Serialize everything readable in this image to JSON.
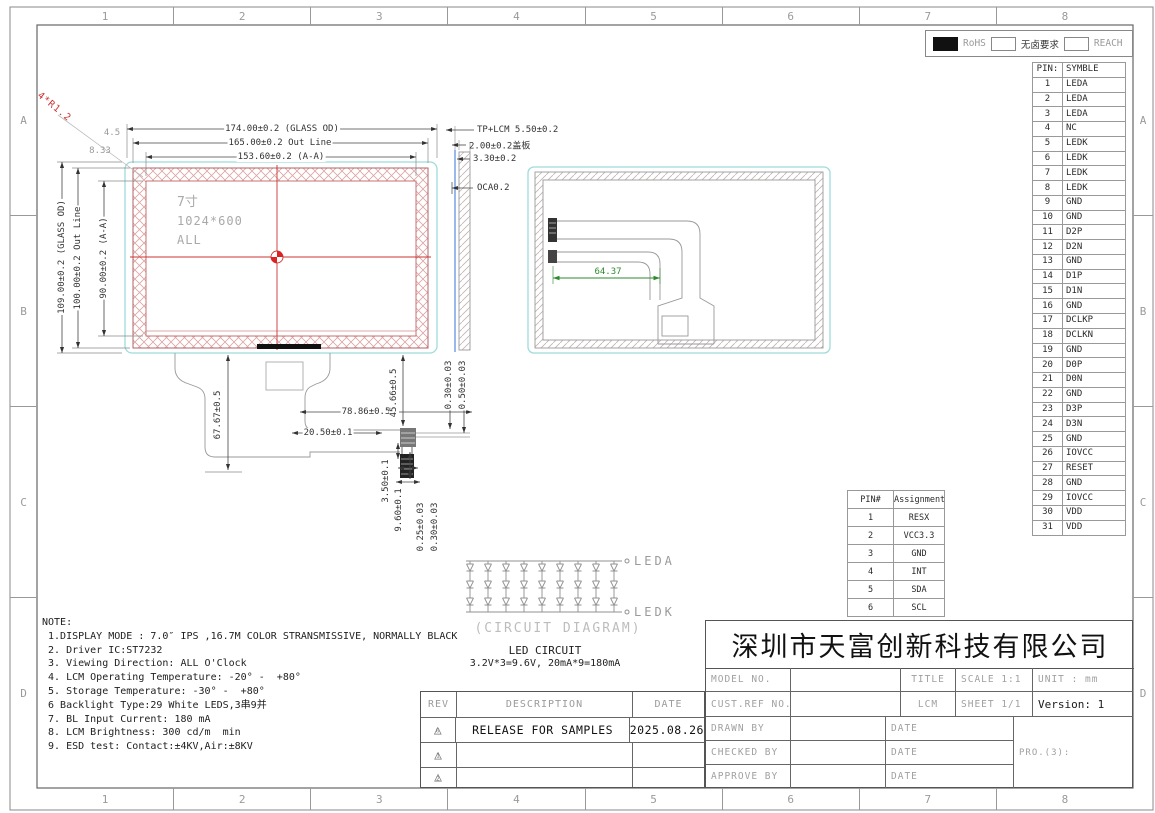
{
  "frame": {
    "cols": [
      "1",
      "2",
      "3",
      "4",
      "5",
      "6",
      "7",
      "8"
    ],
    "rows": [
      "A",
      "B",
      "C",
      "D"
    ]
  },
  "compliance": {
    "rohs": "RoHS",
    "halogen": "无卤要求",
    "reach": "REACH"
  },
  "pin_table": {
    "col1": "PIN:",
    "col2": "SYMBLE",
    "rows": [
      [
        "1",
        "LEDA"
      ],
      [
        "2",
        "LEDA"
      ],
      [
        "3",
        "LEDA"
      ],
      [
        "4",
        "NC"
      ],
      [
        "5",
        "LEDK"
      ],
      [
        "6",
        "LEDK"
      ],
      [
        "7",
        "LEDK"
      ],
      [
        "8",
        "LEDK"
      ],
      [
        "9",
        "GND"
      ],
      [
        "10",
        "GND"
      ],
      [
        "11",
        "D2P"
      ],
      [
        "12",
        "D2N"
      ],
      [
        "13",
        "GND"
      ],
      [
        "14",
        "D1P"
      ],
      [
        "15",
        "D1N"
      ],
      [
        "16",
        "GND"
      ],
      [
        "17",
        "DCLKP"
      ],
      [
        "18",
        "DCLKN"
      ],
      [
        "19",
        "GND"
      ],
      [
        "20",
        "D0P"
      ],
      [
        "21",
        "D0N"
      ],
      [
        "22",
        "GND"
      ],
      [
        "23",
        "D3P"
      ],
      [
        "24",
        "D3N"
      ],
      [
        "25",
        "GND"
      ],
      [
        "26",
        "IOVCC"
      ],
      [
        "27",
        "RESET"
      ],
      [
        "28",
        "GND"
      ],
      [
        "29",
        "IOVCC"
      ],
      [
        "30",
        "VDD"
      ],
      [
        "31",
        "VDD"
      ]
    ]
  },
  "tp_table": {
    "col1": "PIN#",
    "col2": "Assignment",
    "rows": [
      [
        "1",
        "RESX"
      ],
      [
        "2",
        "VCC3.3"
      ],
      [
        "3",
        "GND"
      ],
      [
        "4",
        "INT"
      ],
      [
        "5",
        "SDA"
      ],
      [
        "6",
        "SCL"
      ]
    ]
  },
  "front_view": {
    "size": "7寸",
    "resolution": "1024*600",
    "mode": "ALL"
  },
  "dims": {
    "glass_w": "174.00±0.2 (GLASS OD)",
    "outline_w": "165.00±0.2 Out Line",
    "aa_w": "153.60±0.2 (A-A)",
    "glass_h": "109.00±0.2 (GLASS OD)",
    "outline_h": "100.00±0.2 Out Line",
    "aa_h": "90.00±0.2 (A-A)",
    "corner_r": "4*R1.2",
    "corner_a": "4.5",
    "corner_b": "8.33",
    "fpc_drop": "67.67±0.5",
    "fpc_w": "78.86±0.5",
    "fpc_off": "20.50±0.1",
    "cable_len": "45.66±0.5",
    "t1": "0.30±0.03",
    "t2": "0.50±0.03",
    "gap": "3.50±0.1",
    "conn_len": "9.60±0.1",
    "t3": "0.25±0.03",
    "t4": "0.30±0.03",
    "back_cable": "64.37"
  },
  "side_view": {
    "l1": "TP+LCM 5.50±0.2",
    "l2": "2.00±0.2盖板",
    "l3": "3.30±0.2",
    "l4": "OCA0.2"
  },
  "circuit": {
    "anode": "LEDA",
    "cathode": "LEDK",
    "caption": "(CIRCUIT DIAGRAM)",
    "title": "LED CIRCUIT",
    "spec": "3.2V*3=9.6V, 20mA*9=180mA"
  },
  "notes": {
    "title": "NOTE:",
    "lines": [
      " 1.DISPLAY MODE : 7.0″ IPS ,16.7M COLOR STRANSMISSIVE, NORMALLY BLACK",
      " 2. Driver IC:ST7232",
      " 3. Viewing Direction: ALL O'Clock",
      " 4. LCM Operating Temperature: -20° -  +80°",
      " 5. Storage Temperature: -30° -  +80°",
      " 6 Backlight Type:29 White LEDS,3串9并",
      " 7. BL Input Current: 180 mA",
      " 8. LCM Brightness: 300 cd/m  min",
      " 9. ESD test: Contact:±4KV,Air:±8KV"
    ]
  },
  "title_block": {
    "company": "深圳市天富创新科技有限公司",
    "model_no": "MODEL NO.",
    "cust_ref": "CUST.REF NO.",
    "title_lbl": "TITLE",
    "scale": "SCALE 1:1",
    "unit": "UNIT : mm",
    "lcm": "LCM",
    "sheet": "SHEET 1/1",
    "version": "Version: 1",
    "drawn": "DRAWN BY",
    "checked": "CHECKED BY",
    "approve": "APPROVE BY",
    "date": "DATE",
    "projection": "PRO.(3):"
  },
  "rev_table": {
    "rev": "REV",
    "description": "DESCRIPTION",
    "date": "DATE",
    "rows": [
      {
        "marker": "0",
        "desc": "RELEASE FOR SAMPLES",
        "date": "2025.08.26"
      },
      {
        "marker": "1",
        "desc": "",
        "date": ""
      },
      {
        "marker": "2",
        "desc": "",
        "date": ""
      }
    ]
  }
}
